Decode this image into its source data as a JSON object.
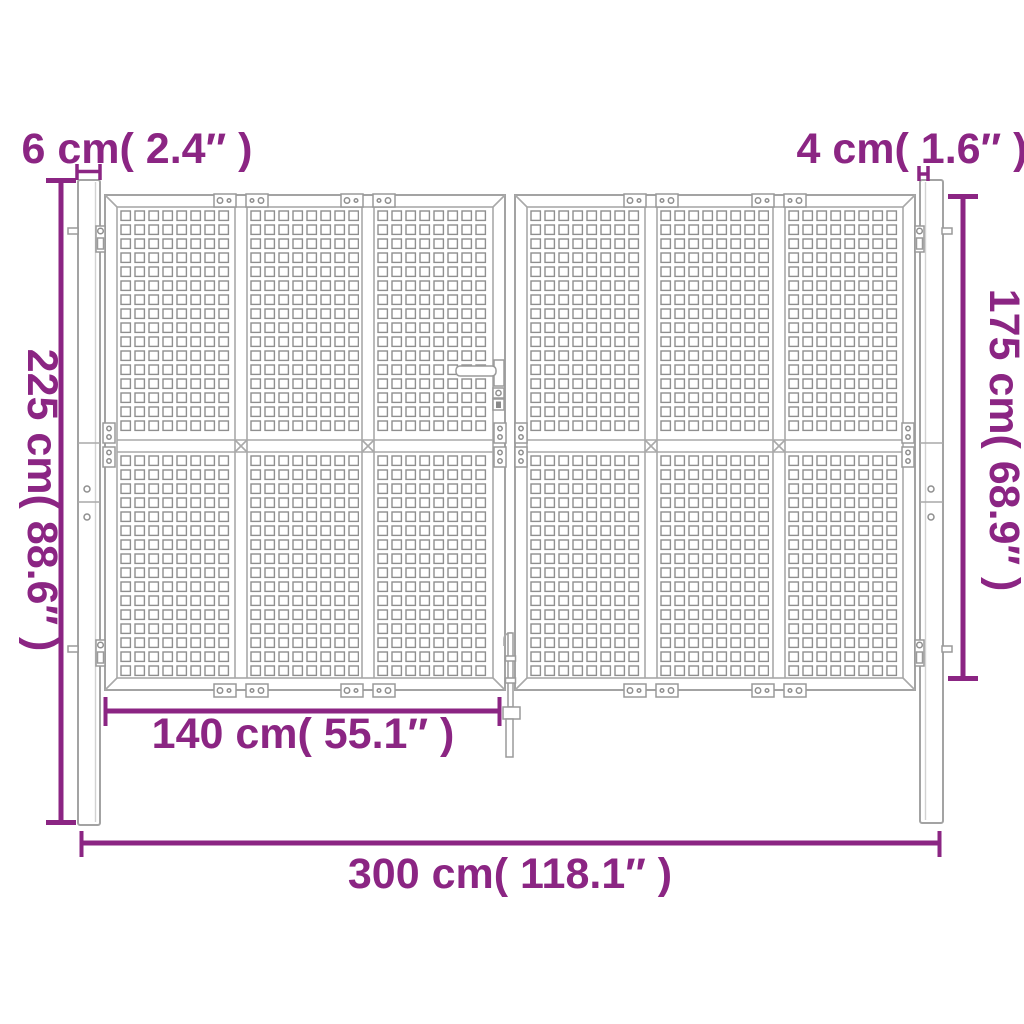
{
  "diagram": {
    "subject": "double-leaf mesh garden gate with two posts, dimension drawing",
    "dimensions": {
      "left_post_width": "6 cm( 2.4″ )",
      "right_post_width": "4 cm( 1.6″ )",
      "post_height": "225 cm( 88.6″ )",
      "gate_height": "175 cm( 68.9″ )",
      "leaf_width": "140 cm( 55.1″ )",
      "total_width": "300 cm( 118.1″ )"
    },
    "colors": {
      "dimension_annotation": "#8b2583",
      "line_art": "#a3a3a3",
      "mesh": "#8f8f8f",
      "background": "#ffffff"
    }
  }
}
